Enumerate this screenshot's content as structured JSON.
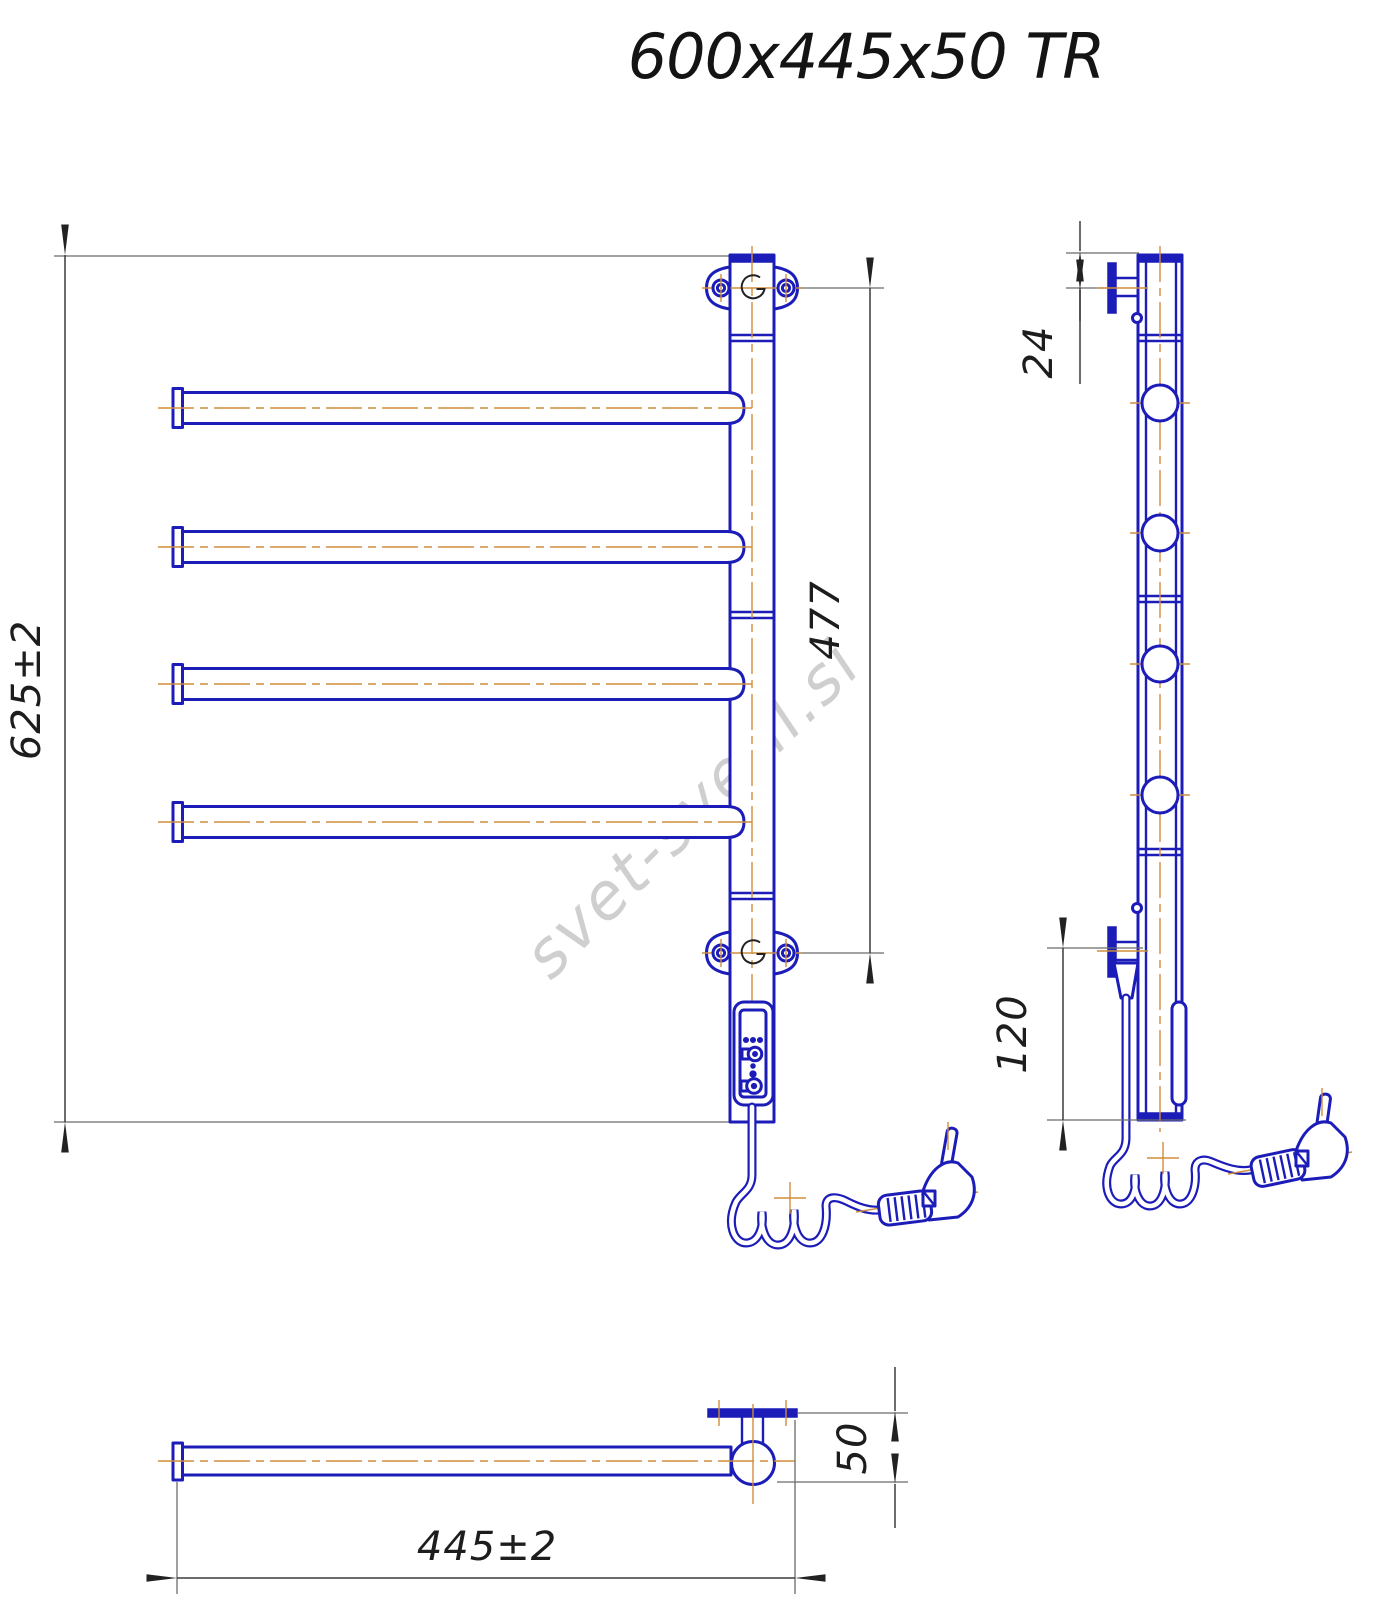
{
  "title": "600x445x50 TR",
  "watermark": "svet-svetil.si",
  "drawing": {
    "type": "technical-drawing",
    "subject": "electric heated towel rail, 4 swivel bars, wall mounted, with control panel and power plug",
    "views": [
      "front",
      "side",
      "bottom"
    ]
  },
  "dimensions": {
    "overall_height": "625±2",
    "bracket_span": "477",
    "top_offset": "24",
    "cable_offset": "120",
    "overall_width": "445±2",
    "depth": "50"
  },
  "colors": {
    "outline": "#1c1cb8",
    "centerline": "#cf8d3c",
    "dimension": "#3c3c3c",
    "watermark": "#c4c4c4"
  }
}
